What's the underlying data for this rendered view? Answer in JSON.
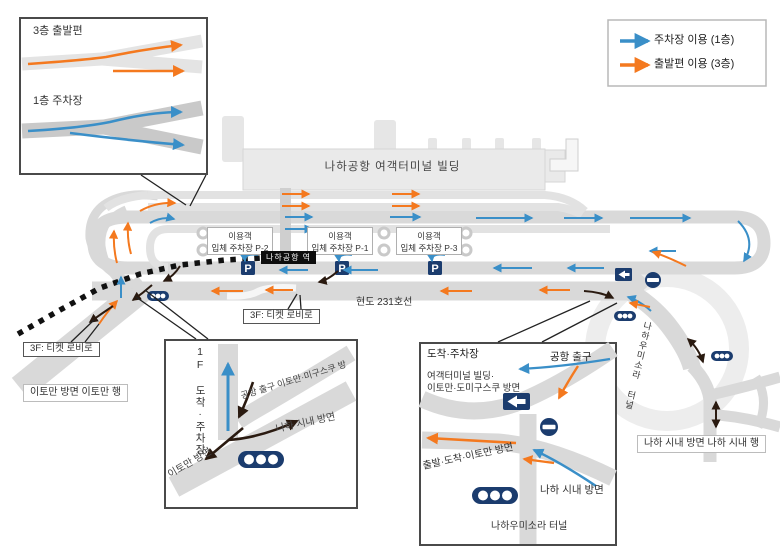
{
  "title": "나하공항 접근 도로 안내도",
  "colors": {
    "blue": "#3a8fc8",
    "orange": "#f4791f",
    "navy": "#1b3c6e",
    "road": "#d9d9d9",
    "black_arrow": "#2a1a10"
  },
  "legend": {
    "items": [
      {
        "label": "주차장 이용 (1층)"
      },
      {
        "label": "출발편 이용 (3층)"
      }
    ]
  },
  "top_inset": {
    "departure_label": "3층 출발편",
    "parking_label": "1층 주차장"
  },
  "terminal_label": "나하공항 여객터미널 빌딩",
  "station_label": "나하공항 역",
  "parking_icon": "P",
  "parking_garages": [
    {
      "line1": "이용객",
      "line2": "입체 주차장 P-2"
    },
    {
      "line1": "이용객",
      "line2": "입체 주차장 P-1"
    },
    {
      "line1": "이용객",
      "line2": "입체 주차장 P-3"
    }
  ],
  "road_labels": {
    "route231": "현도 231호선",
    "ticket_lobby_center": "3F: 티켓 로비로",
    "ticket_lobby_left": "3F: 티켓 로비로",
    "itoman_bound": "이토만 방면 이토만 행",
    "naha_city_bound": "나하 시내 방면 나하 시내 행",
    "tunnel": "나하우미소라 터널"
  },
  "inset_bottom_left": {
    "arrival_parking_vertical": "1F 도착·주차장",
    "airport_exit_road": "공항 출구 이토만·미구스쿠 방",
    "naha_city": "나하 시내 방면",
    "itoman": "이토만 방면"
  },
  "inset_bottom_right": {
    "arrival_parking": "도착·주차장",
    "airport_exit": "공항 출구",
    "terminal_dir_line1": "여객터미널 빌딩·",
    "terminal_dir_line2": "이토만·도미구스쿠 방면",
    "departure_road": "출발·도착·이토만 방면",
    "naha_city": "나하 시내 방면",
    "tunnel": "나하우미소라 터널"
  }
}
